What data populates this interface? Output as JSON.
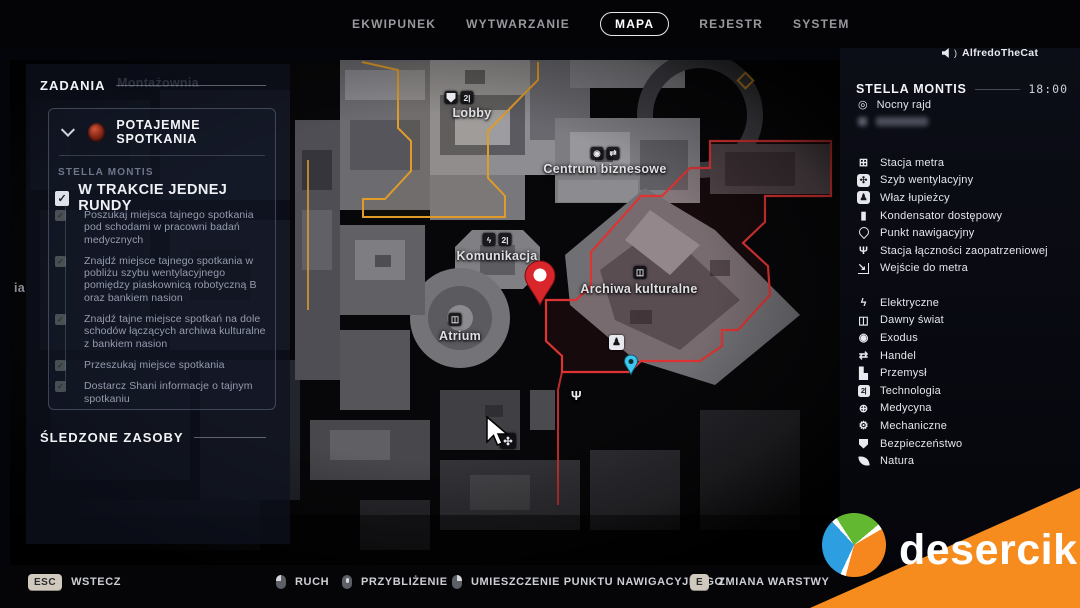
{
  "colors": {
    "accent_yellow": "#e09c28",
    "accent_red": "#dd3333",
    "pin_red": "#d8262c",
    "pin_cyan": "#3ec7ee",
    "brand_orange": "#f68b1e"
  },
  "top_nav": {
    "active": "MAPA",
    "items": [
      {
        "label": "EKWIPUNEK"
      },
      {
        "label": "WYTWARZANIE"
      },
      {
        "label": "MAPA"
      },
      {
        "label": "REJESTR"
      },
      {
        "label": "SYSTEM"
      }
    ]
  },
  "player": {
    "name": "AlfredoTheCat",
    "icon": "speaker-icon"
  },
  "tasks_panel": {
    "title": "ZADANIA",
    "quest": {
      "name": "POTAJEMNE SPOTKANIA",
      "icon": "quest-faction-icon",
      "region": "STELLA MONTIS",
      "objective": "W TRAKCIE JEDNEJ RUNDY",
      "objective_checked": true,
      "subtasks": [
        "Poszukaj miejsca tajnego spotkania pod schodami w pracowni badań medycznych",
        "Znajdź miejsce tajnego spotkania w pobliżu szybu wentylacyjnego pomiędzy piaskownicą robotyczną B oraz bankiem nasion",
        "Znajdź tajne miejsce spotkań na dole schodów łączących archiwa kulturalne z bankiem nasion",
        "Przeszukaj miejsce spotkania",
        "Dostarcz Shani informacje o tajnym spotkaniu"
      ]
    },
    "tracked_title": "ŚLEDZONE ZASOBY"
  },
  "map": {
    "labels": {
      "montazownia": {
        "text": "Montażownia"
      },
      "lobby": {
        "text": "Lobby",
        "icons": [
          "security-icon",
          "technology-icon"
        ]
      },
      "centrum": {
        "text": "Centrum biznesowe",
        "icons": [
          "exodus-icon",
          "trade-icon"
        ]
      },
      "komunikacja": {
        "text": "Komunikacja",
        "icons": [
          "electric-icon",
          "technology-icon"
        ]
      },
      "archiwa": {
        "text": "Archiwa kulturalne",
        "icons": [
          "old-world-icon"
        ]
      },
      "atrium": {
        "text": "Atrium",
        "icons": [
          "old-world-icon"
        ]
      },
      "partial_left": {
        "text": "ia"
      }
    },
    "markers": [
      "waypoint-pin-red",
      "nav-point-pin-cyan",
      "vent-shaft-icon",
      "supply-link-icon",
      "scavenger-hatch-icon",
      "mouse-cursor"
    ]
  },
  "right_panel": {
    "region": "STELLA MONTIS",
    "time": "18:00",
    "events": [
      {
        "icon": "night-raid-icon",
        "label": "Nocny rajd"
      },
      {
        "icon": "blurred",
        "label": "",
        "blurred": true
      }
    ],
    "markers": [
      {
        "icon": "metro-station-icon",
        "glyph": "⊞",
        "label": "Stacja metra"
      },
      {
        "icon": "vent-shaft-icon",
        "glyph": "✣",
        "label": "Szyb wentylacyjny"
      },
      {
        "icon": "scavenger-hatch-icon",
        "glyph": "♟",
        "label": "Właz łupieżcy"
      },
      {
        "icon": "access-capacitor-icon",
        "glyph": "▮",
        "label": "Kondensator dostępowy"
      },
      {
        "icon": "nav-point-icon",
        "label": "Punkt nawigacyjny"
      },
      {
        "icon": "supply-link-station-icon",
        "glyph": "Ψ",
        "label": "Stacja łączności zaopatrzeniowej"
      },
      {
        "icon": "metro-entrance-icon",
        "glyph": "↘",
        "label": "Wejście do metra"
      }
    ],
    "categories": [
      {
        "icon": "electric-icon",
        "glyph": "ϟ",
        "label": "Elektryczne"
      },
      {
        "icon": "old-world-icon",
        "glyph": "◫",
        "label": "Dawny świat"
      },
      {
        "icon": "exodus-icon",
        "glyph": "◉",
        "label": "Exodus"
      },
      {
        "icon": "trade-icon",
        "glyph": "⇄",
        "label": "Handel"
      },
      {
        "icon": "industry-icon",
        "glyph": "▙",
        "label": "Przemysł"
      },
      {
        "icon": "technology-icon",
        "glyph": "2|",
        "label": "Technologia"
      },
      {
        "icon": "medicine-icon",
        "glyph": "⊕",
        "label": "Medycyna"
      },
      {
        "icon": "mechanical-icon",
        "glyph": "⚙",
        "label": "Mechaniczne"
      },
      {
        "icon": "security-icon",
        "label": "Bezpieczeństwo"
      },
      {
        "icon": "nature-icon",
        "label": "Natura"
      }
    ]
  },
  "bottom_bar": {
    "actions": [
      {
        "key": "ESC",
        "label": "WSTECZ"
      },
      {
        "mouse": "left",
        "label": "RUCH"
      },
      {
        "mouse": "wheel",
        "label": "PRZYBLIŻENIE"
      },
      {
        "mouse": "right",
        "label": "UMIESZCZENIE PUNKTU NAWIGACYJNEGO"
      },
      {
        "key": "E",
        "label": "ZMIANA WARSTWY"
      }
    ]
  },
  "watermark": {
    "text": "desercik"
  }
}
